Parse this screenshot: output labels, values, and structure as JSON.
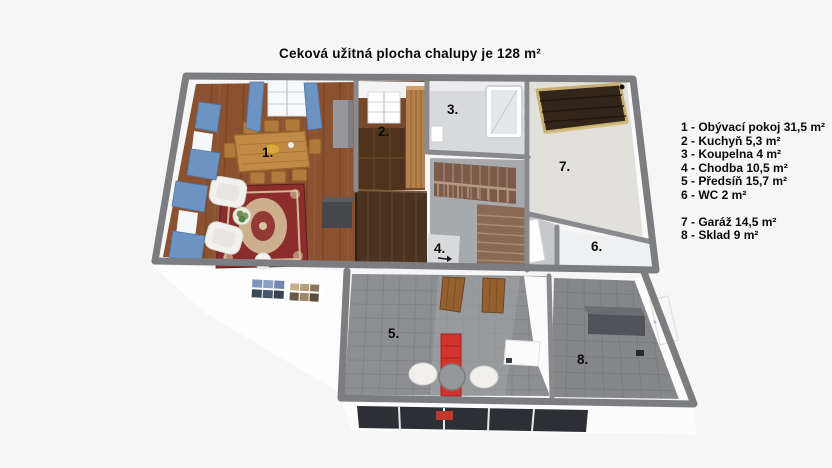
{
  "title": "Ceková užitná plocha chalupy je 128 m²",
  "total_area": "128 m²",
  "legend": {
    "group1": [
      "1 - Obývací pokoj 31,5 m²",
      "2 - Kuchyň 5,3 m²",
      "3 - Koupelna 4 m²",
      "4 - Chodba 10,5 m²",
      "5 - Předsíň 15,7 m²",
      "6 - WC 2 m²"
    ],
    "group2": [
      "7 - Garáž 14,5 m²",
      "8 - Sklad 9 m²"
    ]
  },
  "rooms": [
    {
      "num": "1.",
      "name": "Obývací pokoj",
      "area": "31,5 m²"
    },
    {
      "num": "2.",
      "name": "Kuchyň",
      "area": "5,3 m²"
    },
    {
      "num": "3.",
      "name": "Koupelna",
      "area": "4 m²"
    },
    {
      "num": "4.",
      "name": "Chodba",
      "area": "10,5 m²"
    },
    {
      "num": "5.",
      "name": "Předsíň",
      "area": "15,7 m²"
    },
    {
      "num": "6.",
      "name": "WC",
      "area": "2 m²"
    },
    {
      "num": "7.",
      "name": "Garáž",
      "area": "14,5 m²"
    },
    {
      "num": "8.",
      "name": "Sklad",
      "area": "9 m²"
    }
  ],
  "colors": {
    "background": "#f6f6f7",
    "wall_gray": "#7c7d81",
    "wood_floor": "#8a5230",
    "rug_red": "#8c2c2c",
    "curtain_blue": "#6d93c3",
    "tile_gray": "#8d8f92",
    "accent_red": "#d2342d",
    "garage_door_brown": "#33251a"
  }
}
